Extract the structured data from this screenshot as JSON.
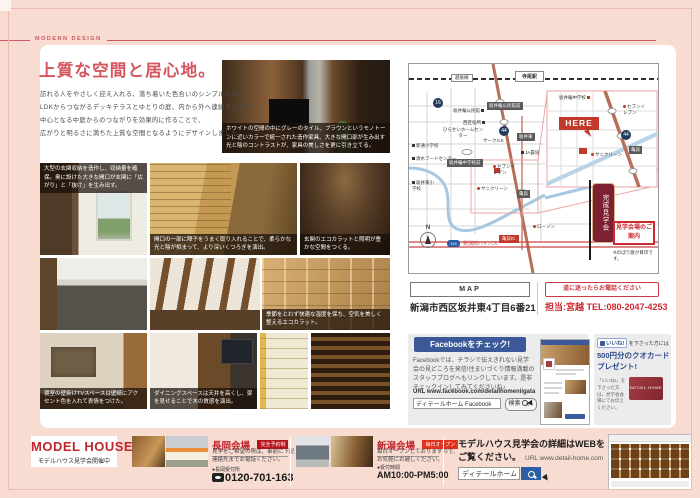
{
  "page": {
    "tagline": "MODERN DESIGN",
    "title": "上質な空間と居心地。",
    "intro": [
      "訪れる人をやさしく迎え入れる、落ち着いた色合いのシンプルな外観。",
      "LDKからつながるデッキテラスとゆとりの庭、内から外へ連続する天井。",
      "中心となる中庭からのつながりを効果的に作ることで、",
      "広がりと明るさに満ちた上質な空間となるようにデザインしました。"
    ]
  },
  "photos": {
    "hero_caption": "ホワイトの空間の中にグレーのタイル、ブラウンというモノトーンに近いカラーで統一された造作家具、大きな開口部が生み出す光と陰のコントラストが、家具の美しさを更に引き立てる。",
    "entry_caption": "大型の玄関収納を造作し、収納量を確保。奥に設けた大きな開口が玄関に「広がり」と「抜け」を生み出す。",
    "shoji_caption": "開口の一部に障子をうまく取り入れることで、柔らかな光と陰が相まって、より深いくつろぎを演出。",
    "ecocarat_entry_caption": "玄関のエコカラットと照明が豊かな空間をつくる。",
    "ecocarat_caption": "季節をとわず快適な湿度を保ち、空気を美しく整えるエコカラット。",
    "bedroom_caption": "寝室の壁掛けTVスペースは壁紙にアクセント色を入れて表情をつけた。",
    "dining_caption": "ダイニングスペースは天井を高くし、梁を見せることで木の質感を演出。"
  },
  "map": {
    "railway": "越後線",
    "station": "寺尾駅",
    "komin": "坂井輪公民館",
    "komin_mae": "坂井輪公民館前",
    "ward_office": "西区役所",
    "elementary1": "新通小学校",
    "home_center": "ひらせいホームセンター",
    "circle_k": "サークルK",
    "food_center": "清水フードセンター",
    "ja": "JA農協",
    "sakaihigashi": "坂井東",
    "junior_high_mae": "坂井輪中学校前",
    "seven": "セブンイレブン",
    "sani": "サニクリーン",
    "elementary2": "坂井東小学校",
    "lawson": "ローソン",
    "kamegai_ic": "亀貝IC",
    "kamegai": "亀貝",
    "bypass": "新潟西バイパス",
    "route16": "16",
    "route44": "44",
    "route116": "116",
    "compass": "N",
    "inset": {
      "junior_high": "坂井輪中学校",
      "seven": "セブンイレブン",
      "here": "HERE",
      "sani": "サニクリーン",
      "kamegai": "亀貝",
      "route44": "44"
    },
    "banner": "完成見学会",
    "guide_box": "見学会場のご案内",
    "flag_note": "※のぼり旗が目印です。",
    "bar_label": "MAP",
    "address": "新潟市西区坂井東4丁目6番21",
    "phone_note": "道に迷ったらお電話ください",
    "contact_person": "担当:宮越",
    "contact_tel": "TEL:080-2047-4253"
  },
  "facebook": {
    "header": "Facebookをチェック!",
    "body": "Facebookでは、チラシで伝えきれない見学会の見どころを発信!住まいづくり情報満載のスタッフブログへもリンクしています。是非チェックインしてみてくださいね♪",
    "url": "URL www.facebook.com/detailhomeniigata",
    "search_value": "ディテールホーム Facebook",
    "search_button": "検索",
    "like_badge": "いいね!",
    "like_suffix": "を下さった方には",
    "prize_line1": "500円分のクオカード",
    "prize_line2": "プレゼント!",
    "prize_note": "「いいね!」を下さった方は、見学会会場にてお伝えください。",
    "card_label": "DETAIL HOME"
  },
  "footer": {
    "logo_title": "MODEL HOUSE",
    "logo_sub": "モデルハウス見学会開催中",
    "nagaoka": {
      "name": "長岡会場",
      "badge": "完全予約制",
      "desc1": "見学をご希望の際は、事前に下記",
      "desc2": "連絡先までお電話ください。",
      "contact_label": "●長岡受付所",
      "tel": "0120-701-163"
    },
    "niigata": {
      "name": "新潟会場",
      "badge": "毎日オープン",
      "desc1": "毎日オープンしておりますので、",
      "desc2": "お気軽にお越しください。",
      "hours_label": "●受付時間",
      "hours": "AM10:00-PM5:00"
    },
    "web": {
      "line1": "モデルハウス見学会の詳細はWEBを",
      "line2": "ご覧ください。",
      "url": "URL www.detail-home.com",
      "search_value": "ディテールホーム"
    }
  }
}
